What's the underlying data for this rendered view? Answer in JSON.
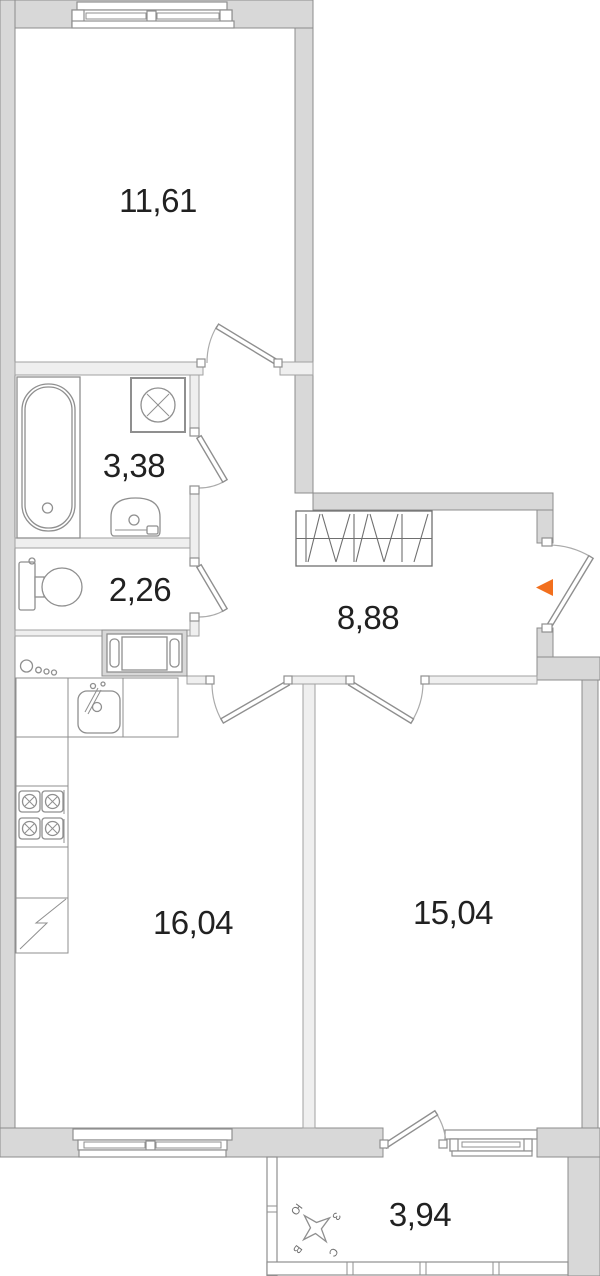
{
  "plan": {
    "type": "apartment floor plan",
    "rooms": [
      {
        "name": "bedroom",
        "area": "11,61"
      },
      {
        "name": "bathroom",
        "area": "3,38"
      },
      {
        "name": "wc",
        "area": "2,26"
      },
      {
        "name": "hallway",
        "area": "8,88"
      },
      {
        "name": "kitchen-living-room",
        "area": "16,04"
      },
      {
        "name": "bedroom-2",
        "area": "15,04"
      },
      {
        "name": "balcony",
        "area": "3,94"
      }
    ],
    "compass": {
      "north": "С",
      "south": "Ю",
      "west": "З",
      "east": "В"
    },
    "entrance_marker_color": "#f26f1d",
    "colors": {
      "wall": "#d8d8d8",
      "wall_border": "#8c8c8c",
      "thin_wall": "#efefef",
      "thin_wall_border": "#a2a2a2",
      "fixture": "#8f8f8f",
      "text": "#212121"
    }
  }
}
